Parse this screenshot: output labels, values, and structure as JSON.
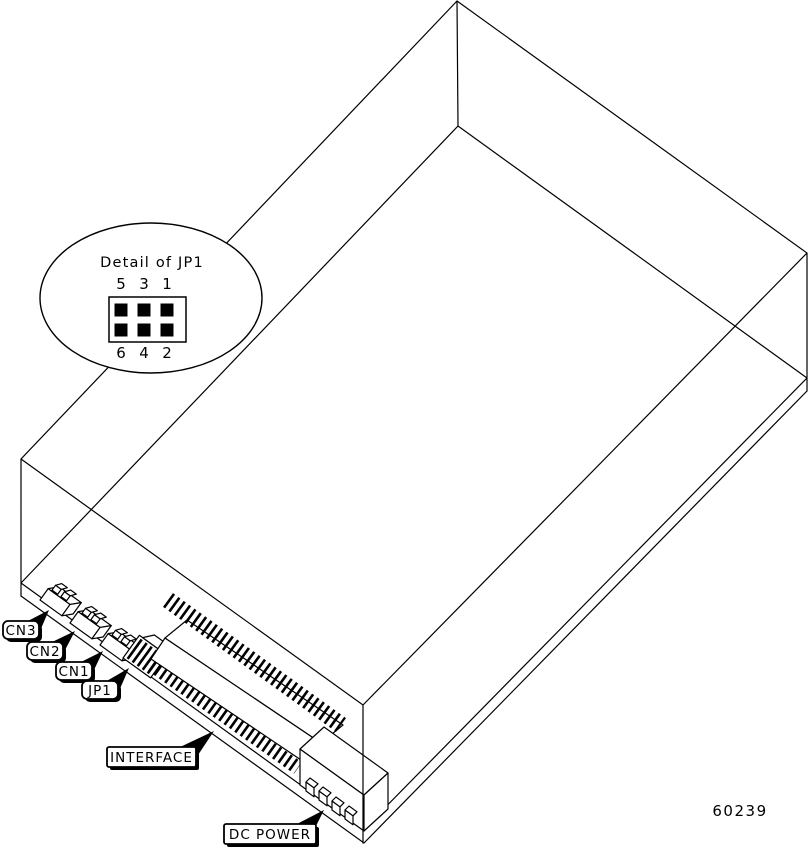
{
  "figure": {
    "number": "60239",
    "detail_bubble": {
      "title": "Detail of JP1",
      "pin_top_row": [
        "5",
        "3",
        "1"
      ],
      "pin_bottom_row": [
        "6",
        "4",
        "2"
      ]
    },
    "callouts": {
      "cn3": "CN3",
      "cn2": "CN2",
      "cn1": "CN1",
      "jp1": "JP1",
      "interface": "INTERFACE",
      "dc_power": "DC POWER"
    },
    "colors": {
      "line": "#000000",
      "background": "#ffffff"
    }
  }
}
